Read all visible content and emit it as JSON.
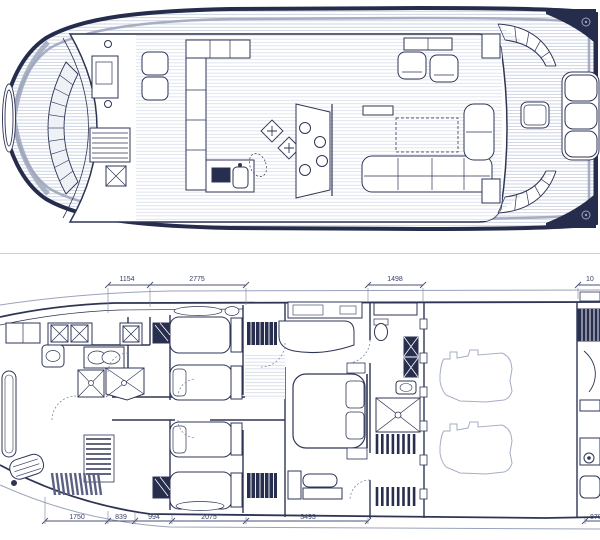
{
  "plans": {
    "main_deck": {
      "name": "main deck plan"
    },
    "lower_deck": {
      "name": "lower deck plan"
    }
  },
  "colors": {
    "line": "#2e3554",
    "dark_fill": "#272e4e",
    "plank": "#bac3d6",
    "plank_light": "#ccd3e2",
    "hull_gray": "#9fa7bd",
    "divider": "#cdd0d9",
    "dim_text": "#3a4163",
    "background": "#ffffff"
  },
  "dimensions": {
    "top_row": [
      "1154",
      "2775",
      "1498",
      "10"
    ],
    "bottom_row": [
      "1750",
      "839",
      "994",
      "2075",
      "3493",
      "870"
    ]
  }
}
